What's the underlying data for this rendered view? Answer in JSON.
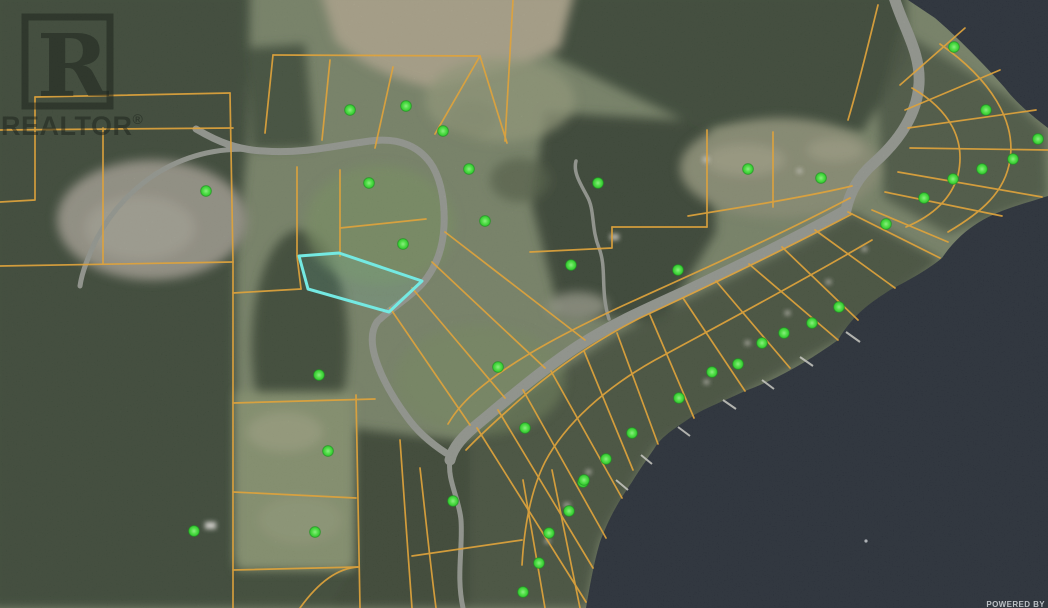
{
  "map": {
    "watermark": {
      "logo_letter": "R",
      "label": "REALTOR",
      "registered_mark": "®"
    },
    "attribution": {
      "powered_by": "POWERED BY"
    },
    "colors": {
      "parcel_line": "#DFA33C",
      "highlight": "#74E9E2",
      "highlight_fill": "rgba(116,233,226,0.10)",
      "marker_edge": "#1E8A1E",
      "water": "#2A313B",
      "land": "#7E8A6D",
      "road": "#9B9E96",
      "watermark": "rgba(28,34,28,0.52)",
      "attribution_text": "#D4D8DC"
    },
    "markers": [
      [
        350,
        110
      ],
      [
        406,
        106
      ],
      [
        443,
        131
      ],
      [
        469,
        169
      ],
      [
        206,
        191
      ],
      [
        369,
        183
      ],
      [
        403,
        244
      ],
      [
        485,
        221
      ],
      [
        598,
        183
      ],
      [
        748,
        169
      ],
      [
        821,
        178
      ],
      [
        678,
        270
      ],
      [
        571,
        265
      ],
      [
        839,
        307
      ],
      [
        954,
        47
      ],
      [
        986,
        110
      ],
      [
        1038,
        139
      ],
      [
        1013,
        159
      ],
      [
        982,
        169
      ],
      [
        953,
        179
      ],
      [
        924,
        198
      ],
      [
        886,
        224
      ],
      [
        812,
        323
      ],
      [
        784,
        333
      ],
      [
        762,
        343
      ],
      [
        738,
        364
      ],
      [
        712,
        372
      ],
      [
        679,
        398
      ],
      [
        632,
        433
      ],
      [
        606,
        459
      ],
      [
        583,
        482
      ],
      [
        525,
        428
      ],
      [
        498,
        367
      ],
      [
        453,
        501
      ],
      [
        328,
        451
      ],
      [
        319,
        375
      ],
      [
        315,
        532
      ],
      [
        194,
        531
      ],
      [
        584,
        480
      ],
      [
        569,
        511
      ],
      [
        549,
        533
      ],
      [
        539,
        563
      ],
      [
        523,
        592
      ]
    ],
    "highlighted_parcel": {
      "points": "299,256 339,253 422,281 389,312 308,289"
    },
    "roads": [
      {
        "name": "highway",
        "d": "M893,-6 C903,28 921,52 919,84 C917,114 900,140 874,163 C858,177 850,192 846,210 C800,236 742,264 688,290 C642,311 612,324 578,346 C543,369 508,399 479,423 C463,436 453,447 450,460",
        "w": 11
      },
      {
        "name": "highway-branch",
        "d": "M450,460 C447,480 459,498 461,520 C463,548 456,576 463,608",
        "w": 5
      },
      {
        "name": "loop-road",
        "d": "M196,129 C218,142 238,150 264,151 C302,154 332,146 370,141 C400,137 421,147 433,167 C442,183 445,205 444,226 C443,248 436,268 422,284 C406,301 388,310 377,322 C371,331 371,343 375,357 C381,377 393,398 407,417 C417,431 429,442 446,453",
        "w": 7
      },
      {
        "name": "west-road",
        "d": "M264,151 C230,146 196,152 166,168 C136,184 112,210 97,238 C88,257 82,272 80,286",
        "w": 5
      },
      {
        "name": "north-trail",
        "d": "M609,319 C600,291 607,268 599,248 C591,228 595,210 587,196 C580,183 573,172 576,161",
        "w": 3.5
      }
    ],
    "parcel_lines": [
      "M35,97 L230,93",
      "M35,97 L35,200 L0,202",
      "M230,93 L233,262",
      "M0,266 L233,262",
      "M0,130 L233,128",
      "M103,128 L103,264",
      "M233,262 L233,608",
      "M233,403 L375,399",
      "M233,492 L356,498",
      "M233,570 L358,567",
      "M356,395 L360,608",
      "M273,55 L480,56",
      "M273,55 L265,133",
      "M330,60 L322,140",
      "M393,67 L375,148",
      "M480,56 L435,134",
      "M480,56 L507,143",
      "M513,0 L505,141",
      "M297,167 L297,256 L301,289",
      "M233,293 L301,289",
      "M340,170 L340,256",
      "M340,228 L426,219",
      "M445,232 L585,340",
      "M432,262 L545,368",
      "M412,288 L505,398",
      "M390,308 L470,425",
      "M850,198 C770,240 690,275 620,307 C575,328 520,355 480,388 C465,400 455,412 448,424",
      "M852,214 C780,252 700,290 640,318 C600,338 560,365 525,395 C500,417 480,435 466,450",
      "M707,130 L707,227",
      "M612,227 L707,227",
      "M612,227 L612,248 L530,252",
      "M773,132 L773,207",
      "M688,216 C750,206 810,196 852,186",
      "M900,85 L965,28",
      "M905,110 L1000,70",
      "M908,128 L1036,110",
      "M910,148 L1048,150",
      "M898,172 L1042,197",
      "M885,192 L1002,216",
      "M872,210 L948,242",
      "M940,44 C992,80 1016,122 1010,160 C1005,192 982,212 948,232",
      "M912,88 C950,110 966,140 958,175 C951,200 932,216 906,227",
      "M878,5 C868,45 860,80 848,120",
      "M848,212 L940,258",
      "M815,230 L895,288",
      "M782,247 L858,320",
      "M749,264 L838,340",
      "M716,281 L790,368",
      "M683,298 L745,391",
      "M650,315 L694,418",
      "M617,333 L658,444",
      "M584,351 L633,470",
      "M551,371 L622,498",
      "M523,390 L606,538",
      "M498,410 L593,568",
      "M477,428 L586,602",
      "M872,240 C790,288 710,330 655,360 C605,388 565,424 545,462 C530,492 524,530 522,565",
      "M400,440 C404,500 408,552 412,608",
      "M420,468 C426,520 430,562 436,608",
      "M523,480 L545,608",
      "M552,470 L580,608",
      "M412,556 L522,540",
      "M300,608 C320,580 340,568 358,567"
    ]
  }
}
